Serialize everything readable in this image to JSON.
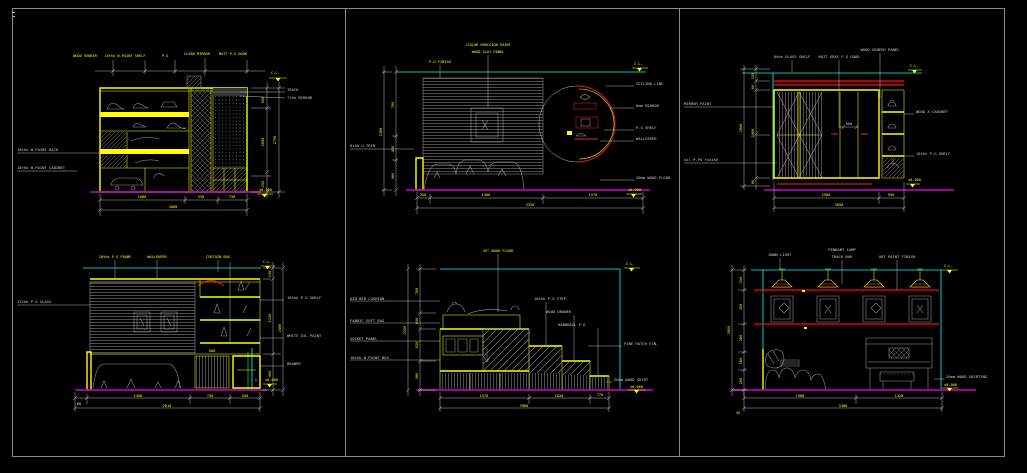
{
  "sheet": {
    "background": "#000000",
    "frame_color": "#8c8c8c"
  },
  "colors": {
    "line_yellow": "#ffff00",
    "line_cyan": "#00ffff",
    "line_magenta": "#b400b4",
    "line_red": "#ff2222",
    "line_white": "#cfcfcf",
    "hatch_gray": "#9a9a9a",
    "accent_green": "#00cc33"
  },
  "p1": {
    "top_notes": [
      "WOOD VENEER",
      "18thk W.PAINT SHELF",
      "P.G",
      "CLEAR MIRROR",
      "MATT P.G DOOR"
    ],
    "right_notes": [
      "TRACK",
      "7thk MIRROR"
    ],
    "left_notes": [
      "18thk W.PAINT RACK",
      "18thk W.PAINT CABINET"
    ],
    "dim_v": [
      "500",
      "2000",
      "250"
    ],
    "dim_v_total": "2750",
    "dim_h": [
      "1800",
      "530",
      "730"
    ],
    "dim_h_total": "3060",
    "elev_top": "C.L.",
    "elev_floor": "±0.000"
  },
  "p2": {
    "top_note": "P.G FINISH",
    "center_note_line1": "+COLOR EMULSION PAINT",
    "center_note_line2": "WOOD SLAT PANEL",
    "left_note": "8thk U-TRIM",
    "right_notes": [
      "CEILING LINE",
      "8mm MIRROR",
      "P.G SHELF",
      "WALLPAPER"
    ],
    "floor_note": "20mm WOOD FLOOR",
    "dim_v": [
      "700",
      "450",
      "480"
    ],
    "dim_v_total": "2380",
    "dim_h": [
      "350",
      "1400",
      "1570"
    ],
    "dim_h_total": "3320",
    "elev_top": "C.L.",
    "elev_floor": "±0.000"
  },
  "p3": {
    "top_notes": [
      "8thk GLASS SHELF",
      "MATT GRAY P.G DOOR",
      "WOOD VENEER PANEL"
    ],
    "left_notes": [
      "MIRROR PAINT",
      "oil P.PG finish"
    ],
    "right_notes": [
      "WOOD X CABINET",
      "18thk P.G SHELF"
    ],
    "inner_dim": "600",
    "dim_v": [
      "150",
      "60",
      "2400",
      "80"
    ],
    "dim_v_total": "2840",
    "dim_h": [
      "2500",
      "550"
    ],
    "dim_h_total": "3050",
    "elev_top": "C.L.",
    "elev_floor": "±0.000"
  },
  "p4": {
    "top_notes": [
      "18thk P.G FRAME",
      "WALLPAPER",
      "CURTAIN BOX"
    ],
    "left_note": "12thk P.G GLASS",
    "right_notes": [
      "18thk P.G SHELF",
      "WHITE OIL PAINT",
      "DRAWER"
    ],
    "inner_dim": "580",
    "dim_v": [
      "130",
      "1120",
      "400"
    ],
    "dim_v_total": "2400",
    "dim_h_first": "60",
    "dim_h": [
      "1450",
      "750",
      "550"
    ],
    "dim_h_total": "2810",
    "elev_top": "C.L.",
    "elev_floor": "±0.000"
  },
  "p5": {
    "top_note": "45° WOOD FLOOR",
    "left_notes": [
      "KID BED CUSHION",
      "FABRIC SOFT BAG",
      "SOCKET PANEL",
      "18thk W.PAINT BOX"
    ],
    "step_notes": [
      "18thk P.G STEP",
      "WOOD DRAWER",
      "HANDRAIL P.G"
    ],
    "right_note": "PINE HATCH FIN.",
    "floor_note": "20mm WOOD SKIRT",
    "dim_v": [
      "700",
      "650",
      "620",
      "580"
    ],
    "dim_v_total": "2550",
    "dim_h": [
      "1570",
      "1620",
      "770"
    ],
    "dim_h_total": "3960",
    "elev_top": "C.L.",
    "elev_floor": "±0.000"
  },
  "p6": {
    "top_notes": [
      "DOWN LIGHT",
      "PENDANT LAMP",
      "TRACK BAR",
      "ART PAINT FINISH"
    ],
    "floor_note": "20mm WOOD SKIRTING",
    "dim_v": [
      "250",
      "350",
      "280",
      "180",
      "200"
    ],
    "dim_v_total": "2850",
    "dim_h_first": "45",
    "dim_h": [
      "1980",
      "1320"
    ],
    "dim_h_total": "3300",
    "elev_top": "C.L.",
    "elev_floor": "±0.000"
  }
}
